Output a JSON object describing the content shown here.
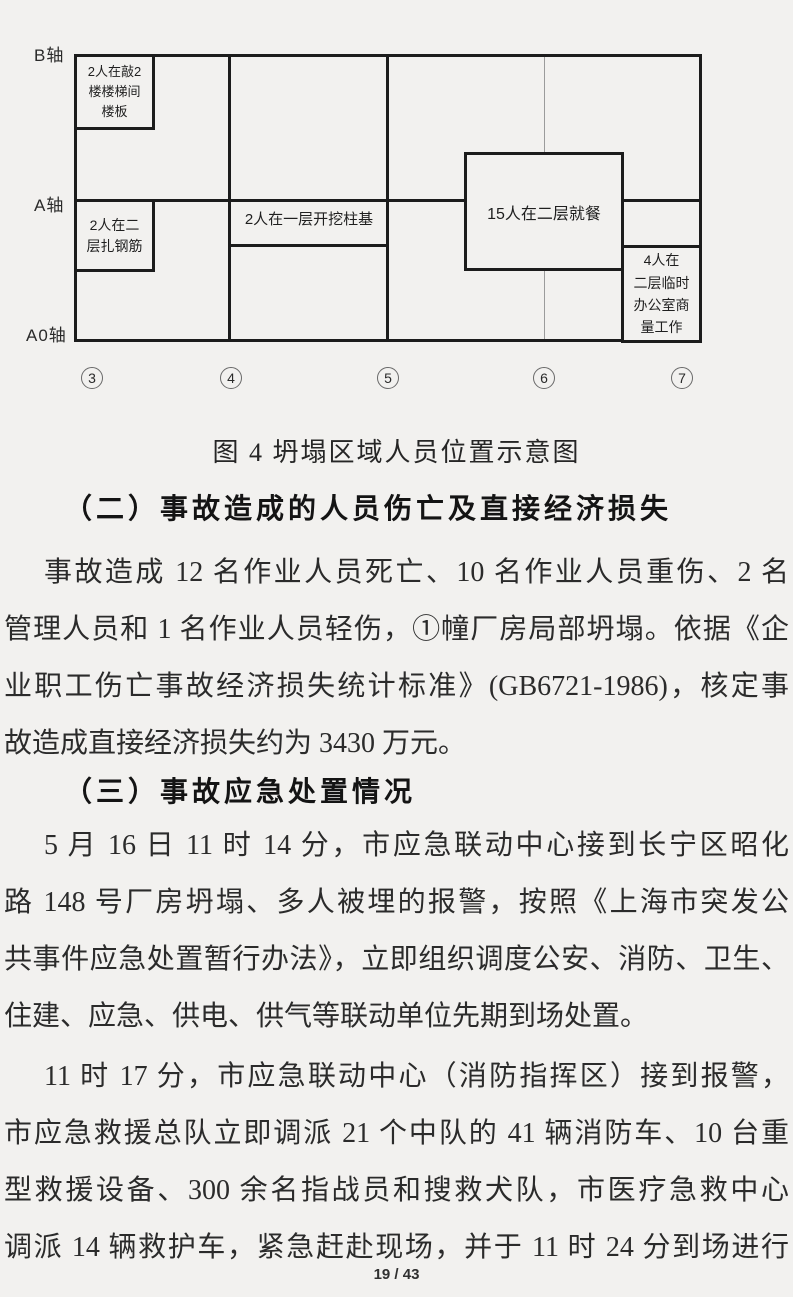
{
  "diagram": {
    "axis_labels": [
      "B轴",
      "A轴",
      "A0轴"
    ],
    "column_labels": [
      "3",
      "4",
      "5",
      "6",
      "7"
    ],
    "boxes": {
      "knock": "2人在敲2\n楼楼梯间\n楼板",
      "rebar": "2人在二\n层扎钢筋",
      "excavate": "2人在一层开挖柱基",
      "dining": "15人在二层就餐",
      "office": "4人在\n二层临时\n办公室商\n量工作"
    },
    "caption": "图 4 坍塌区域人员位置示意图"
  },
  "sections": {
    "heading2": "（二）事故造成的人员伤亡及直接经济损失",
    "para1_lines": [
      "事故造成 12 名作业人员死亡、10 名作业人员重伤、2 名",
      "管理人员和 1 名作业人员轻伤，①幢厂房局部坍塌。依据《企",
      "业职工伤亡事故经济损失统计标准》(GB6721-1986)，核定事",
      "故造成直接经济损失约为 3430 万元。"
    ],
    "heading3": "（三）事故应急处置情况",
    "para2_lines": [
      "5 月 16 日 11 时 14 分，市应急联动中心接到长宁区昭化",
      "路 148 号厂房坍塌、多人被埋的报警，按照《上海市突发公",
      "共事件应急处置暂行办法》，立即组织调度公安、消防、卫生、",
      "住建、应急、供电、供气等联动单位先期到场处置。"
    ],
    "para3_lines": [
      "11 时 17 分，市应急联动中心（消防指挥区）接到报警，",
      "市应急救援总队立即调派 21 个中队的 41 辆消防车、10 台重",
      "型救援设备、300 余名指战员和搜救犬队，市医疗急救中心",
      "调派 14 辆救护车，紧急赶赴现场，并于 11 时 24 分到场进行"
    ]
  },
  "footer": {
    "page_indicator": "19 / 43"
  }
}
